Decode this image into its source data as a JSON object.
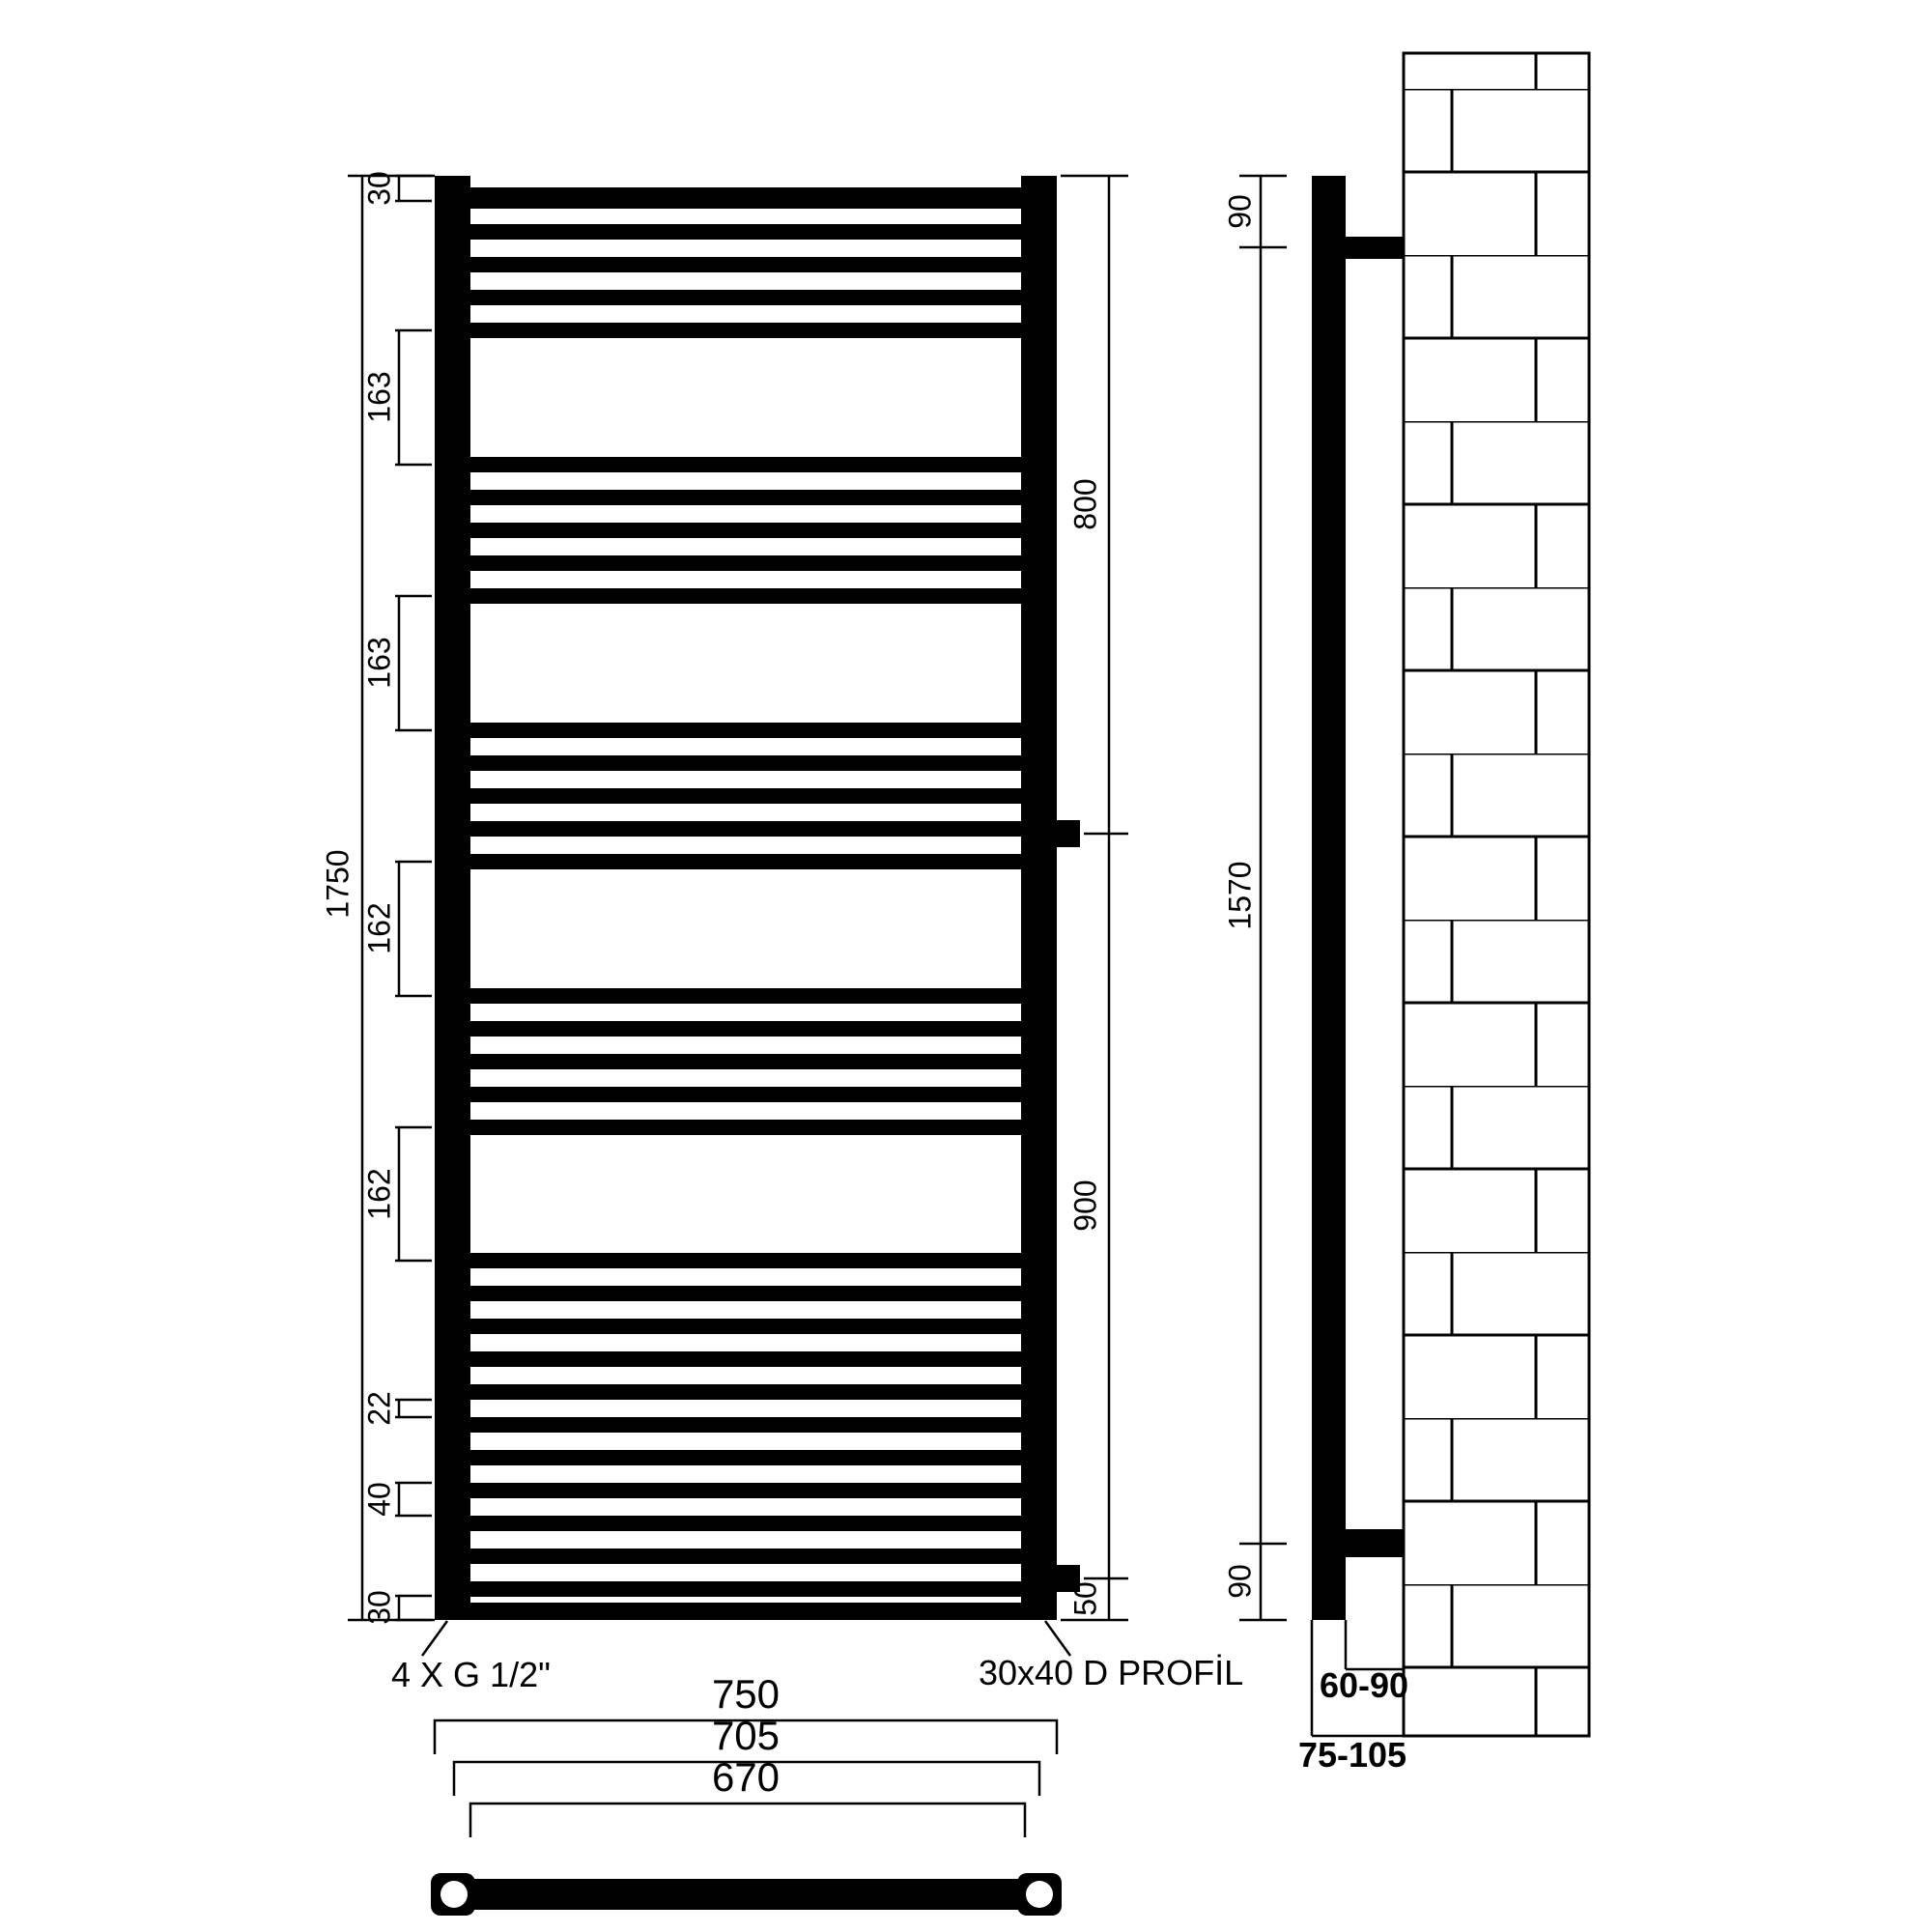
{
  "front_view": {
    "left_dims": {
      "top_rail": "30",
      "gap_1": "163",
      "gap_2": "163",
      "overall_height": "1750",
      "gap_3": "162",
      "gap_4": "162",
      "rung_gap": "22",
      "rung_pitch": "40",
      "bottom_rail": "30"
    },
    "right_dims": {
      "top_to_side_inlet": "800",
      "side_to_bottom_inlet": "900",
      "bottom_inlet_offset": "50"
    },
    "width_dims": {
      "overall_width": "750",
      "pipe_centers": "705",
      "inner_width": "670"
    },
    "callouts": {
      "connections": "4 X G 1/2\"",
      "profile": "30x40 D PROFİL"
    }
  },
  "side_view": {
    "top_bracket_offset": "90",
    "bracket_span": "1570",
    "bottom_bracket_offset": "90",
    "clearance_back": "60-90",
    "clearance_front": "75-105"
  }
}
